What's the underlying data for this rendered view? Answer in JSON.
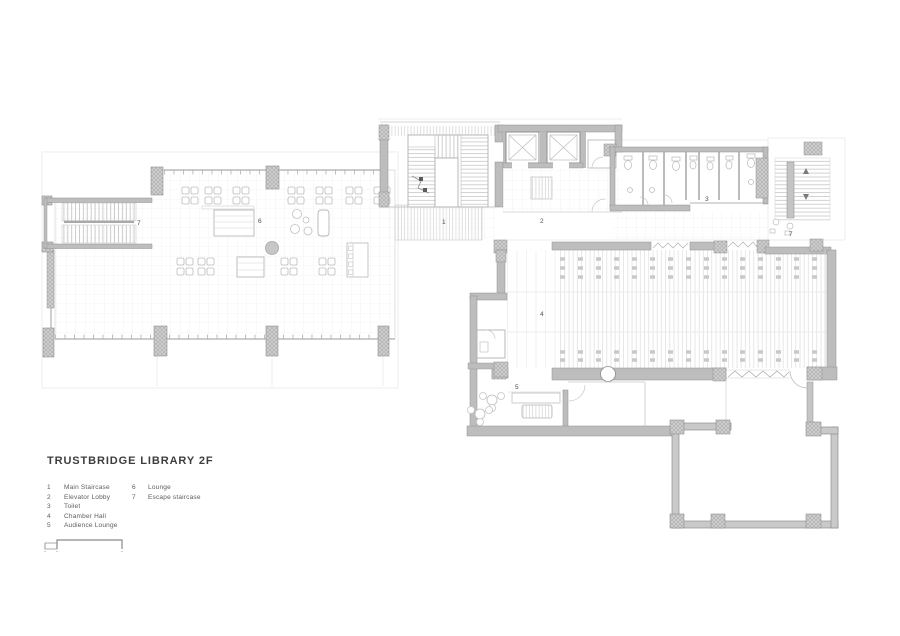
{
  "title": "TRUSTBRIDGE LIBRARY 2F",
  "legend": {
    "items": [
      {
        "num": "1",
        "label": "Main Staircase"
      },
      {
        "num": "2",
        "label": "Elevator Lobby"
      },
      {
        "num": "3",
        "label": "Toilet"
      },
      {
        "num": "4",
        "label": "Chamber Hall"
      },
      {
        "num": "5",
        "label": "Audience Lounge"
      },
      {
        "num": "6",
        "label": "Lounge"
      },
      {
        "num": "7",
        "label": "Escape staircase"
      }
    ]
  },
  "plan_labels": {
    "escape_left": "7",
    "lounge": "6",
    "main_staircase": "1",
    "elevator_lobby": "2",
    "toilet": "3",
    "escape_right": "7",
    "chamber_hall": "4",
    "audience_lounge": "5"
  },
  "colors": {
    "wall": "#bdbdbd",
    "wall_edge": "#8f8f8f",
    "column": "#c9c9c9",
    "hatch": "#dcdcdc",
    "faint": "#e8e8e8",
    "label_text": "#4f4f4f",
    "title_text": "#3d3d3d"
  }
}
